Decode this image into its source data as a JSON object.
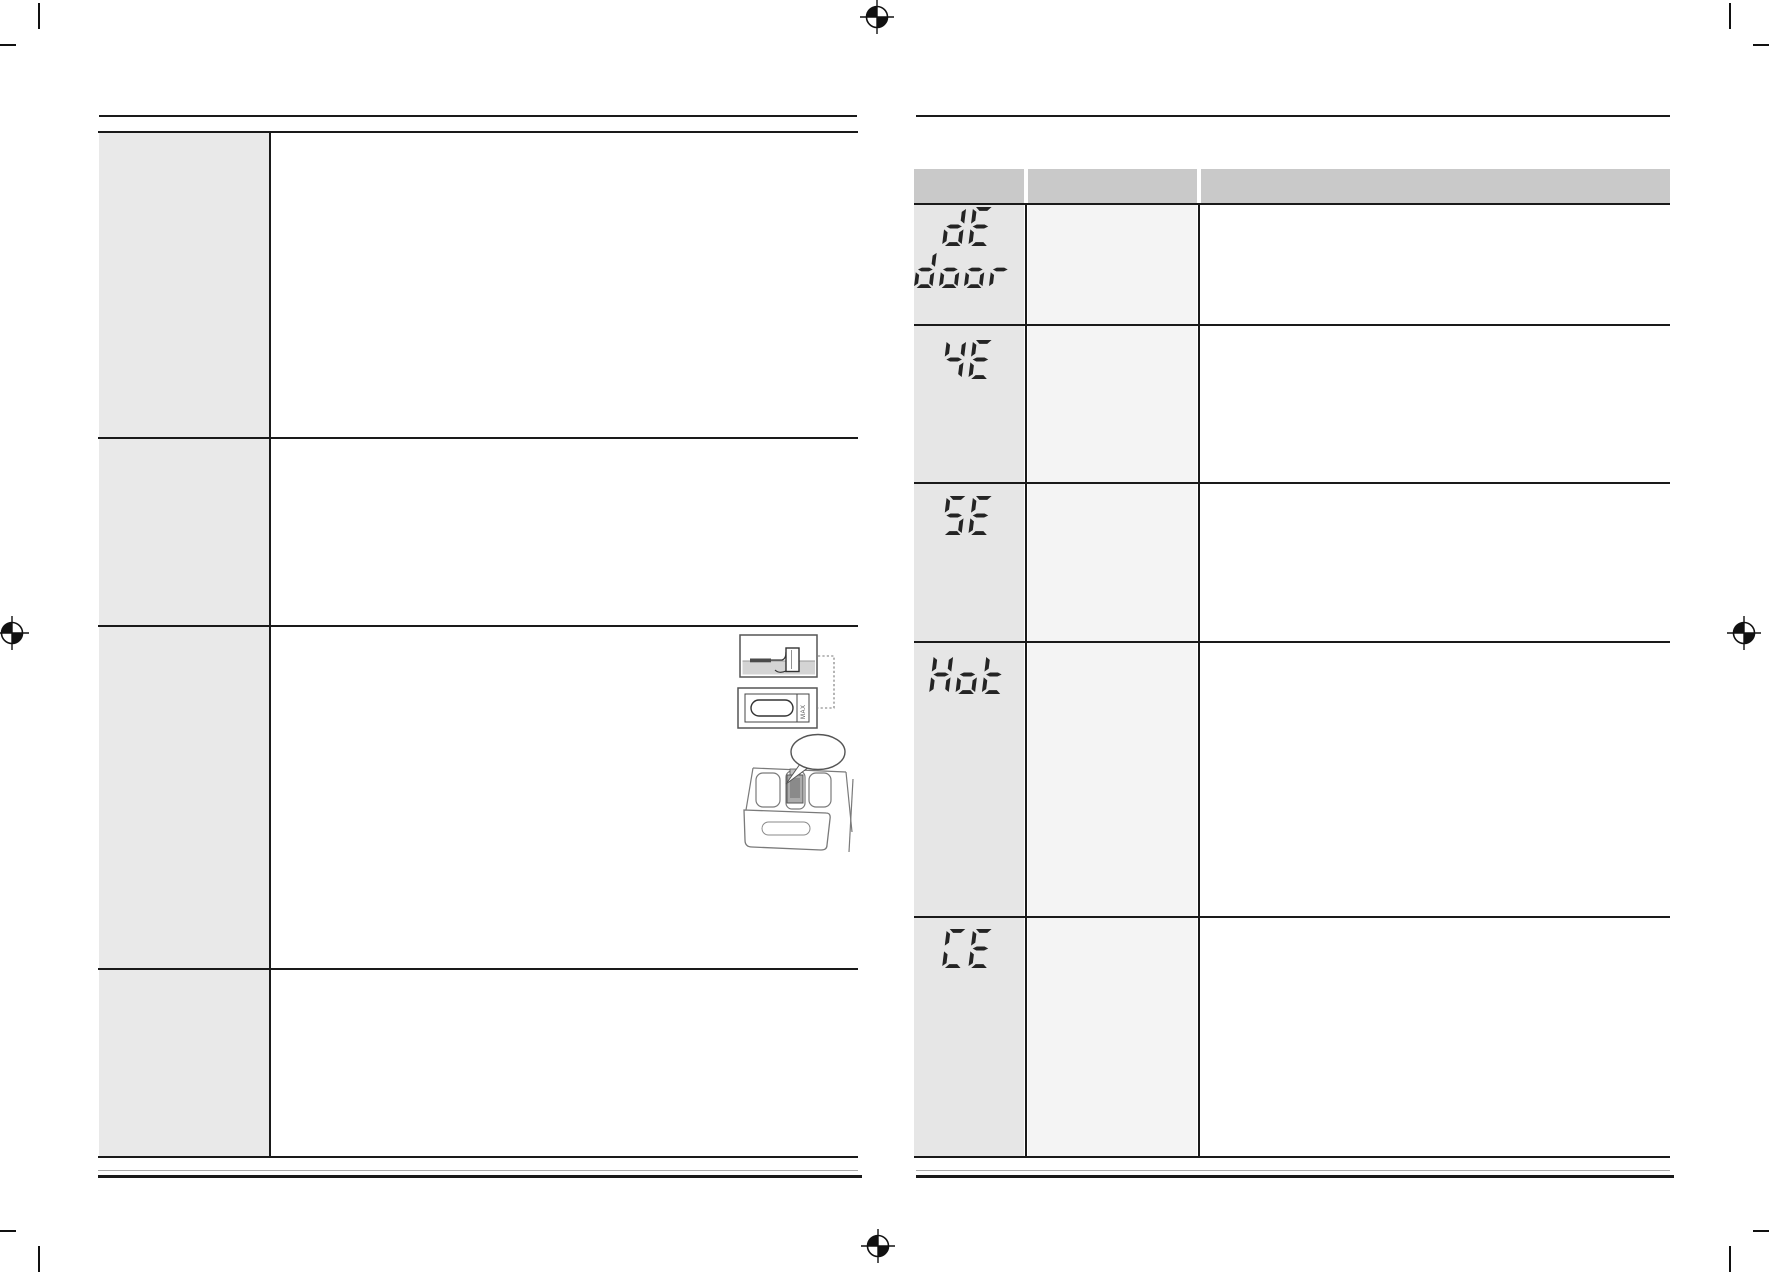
{
  "document": {
    "kind": "washing machine manual troubleshooting spread (scanned page pair)",
    "left_page": {
      "table": {
        "rows": 4,
        "label_column": true
      },
      "illustration": {
        "max_label": "MAX"
      }
    },
    "right_page": {
      "error_code_table": {
        "columns": 3,
        "header_visible_text": "",
        "rows": [
          {
            "code": "dE",
            "code_line2": "door"
          },
          {
            "code": "4E",
            "code_line2": ""
          },
          {
            "code": "5E",
            "code_line2": ""
          },
          {
            "code": "Hot",
            "code_line2": ""
          },
          {
            "code": "CE",
            "code_line2": ""
          }
        ]
      }
    },
    "colors": {
      "header_gray": "#c9c9c9",
      "left_label_gray": "#e9e9e9",
      "right_code_col_gray": "#e6e6e6",
      "right_mid_col_gray": "#f4f4f4",
      "border_dark": "#1a1a1a",
      "segment_display": "#242424"
    }
  }
}
